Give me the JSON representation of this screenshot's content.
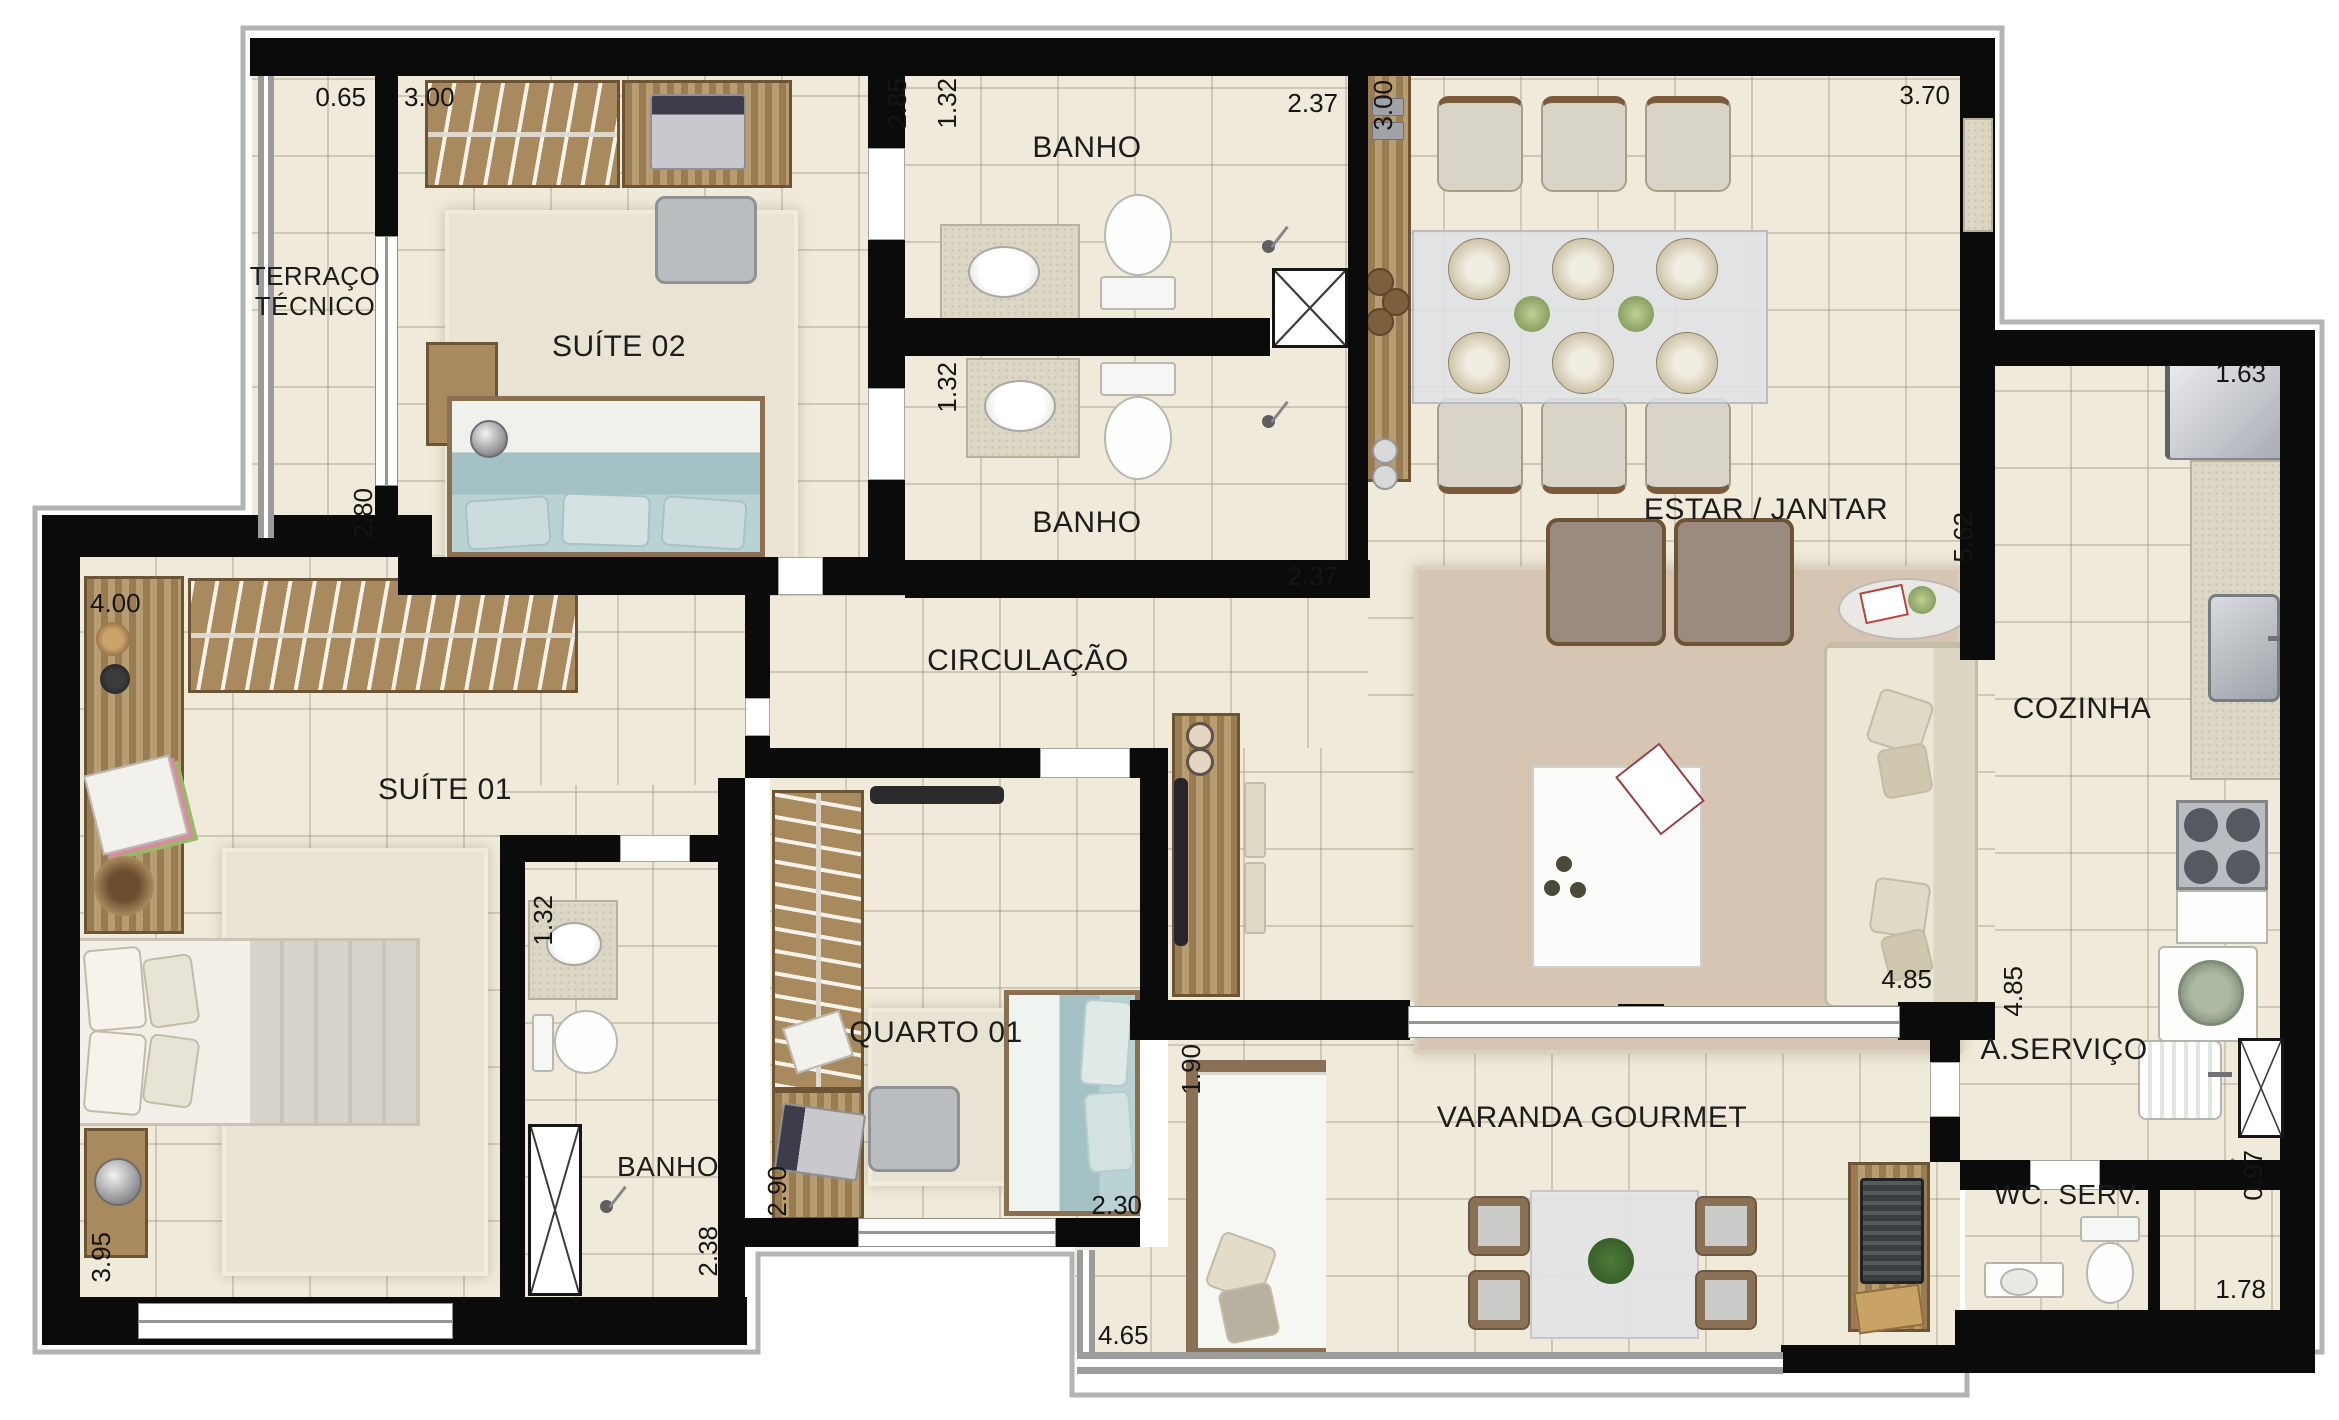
{
  "plan_title": "Apartment floor plan",
  "rooms": {
    "terraco": {
      "label": "TERRAÇO TÉCNICO"
    },
    "suite02": {
      "label": "SUÍTE 02"
    },
    "banho_sup1": {
      "label": "BANHO"
    },
    "banho_sup2": {
      "label": "BANHO"
    },
    "estar": {
      "label": "ESTAR / JANTAR"
    },
    "cozinha": {
      "label": "COZINHA"
    },
    "circulacao": {
      "label": "CIRCULAÇÃO"
    },
    "suite01": {
      "label": "SUÍTE 01"
    },
    "banho_suite01": {
      "label": "BANHO"
    },
    "quarto01": {
      "label": "QUARTO 01"
    },
    "varanda": {
      "label": "VARANDA GOURMET"
    },
    "servico": {
      "label": "A.SERVIÇO"
    },
    "wc": {
      "label": "WC. SERV."
    }
  },
  "dimensions": {
    "terraco_w": "0.65",
    "suite02_w": "3.00",
    "terraco_d": "2.80",
    "closet_d": "2.85",
    "banho1_w": "1.32",
    "banho1_d": "2.37",
    "banho2_w": "1.32",
    "banho2_d": "2.37",
    "hall_d": "3.00",
    "estar_w": "3.70",
    "cozinha_w": "1.63",
    "estar_d": "5.62",
    "suite01_w": "4.00",
    "banho01_w": "1.32",
    "banho01_d": "2.38",
    "suite01_d": "3.95",
    "quarto_w": "2.90",
    "quarto_bed": "2.30",
    "varanda_d": "1.90",
    "varanda_w": "4.65",
    "living_w": "4.85",
    "servico_d": "4.85",
    "wc_shower_w": "0.97",
    "wc_w": "1.78"
  },
  "icons": {
    "shower": "shower-head-icon",
    "duct": "ventilation-duct-x-icon"
  },
  "colors": {
    "wall": "#0b0b0b",
    "floor": "#efead9",
    "wood": "#a98a5f",
    "bed_teal": "#a4c2c6",
    "rug_living": "#d5c5b2",
    "rail_gray": "#9c9c9c"
  }
}
